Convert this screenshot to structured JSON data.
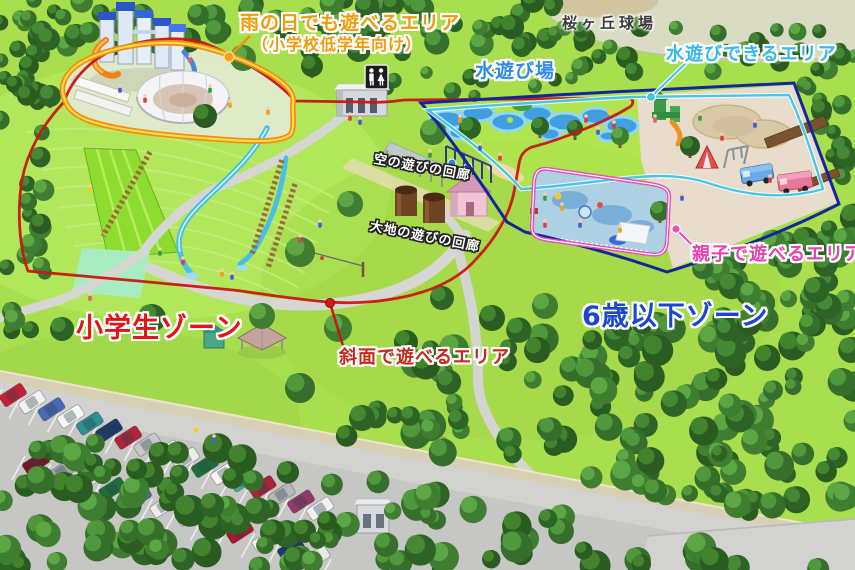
{
  "map": {
    "labels": {
      "rain_area": {
        "line1": "雨の日でも遊べるエリア",
        "line2": "（小学校低学年向け）",
        "color": "#f29a08"
      },
      "ballpark": {
        "text": "桜ヶ丘球場",
        "color": "#3a3a3a"
      },
      "water_play_spot": {
        "text": "水遊び場",
        "color": "#2e8ce8"
      },
      "water_play_area": {
        "text": "水遊びできるエリア",
        "color": "#35b8ec"
      },
      "sky_corridor": {
        "text": "空の遊びの回廊",
        "color": "#ffffff"
      },
      "earth_corridor": {
        "text": "大地の遊びの回廊",
        "color": "#ffffff"
      },
      "parent_child_area": {
        "text": "親子で遊べるエリア",
        "color": "#ea3fae"
      },
      "under_six_zone": {
        "text": "6歳以下ゾーン",
        "color": "#1b46d0"
      },
      "elementary_zone": {
        "text": "小学生ゾーン",
        "color": "#e41414"
      },
      "slope_play_area": {
        "text": "斜面で遊べるエリア",
        "color": "#c8281c"
      }
    },
    "zone_line_colors": {
      "elementary": "#c81810",
      "under_six": "#15259a",
      "rain": "#f08c10",
      "water": "#45c8e8",
      "parent_child": "#e84fb8"
    },
    "icons": {
      "restroom_sign": "male-and-female-figures"
    },
    "parking": {
      "row_upper_car_colors": [
        "#c22233",
        "#f2f2f0",
        "#4a6ab8",
        "#f8f8f6",
        "#2f9090",
        "#1c3a6e",
        "#b22438",
        "#c8c8c8",
        "#f4f4f2",
        "#ececea",
        "#1f7038",
        "#f6f6f4",
        "#3fa8a0",
        "#aa2438",
        "#b8b8b8",
        "#8f3a68",
        "#f2f2f0"
      ],
      "row_lower_car_colors": [
        "#7a1526",
        "#a8a8a8",
        "#f4f4f2",
        "#1f7038",
        "#4a6ab8",
        "#ececea",
        "#d8d8d6",
        "#f6f6f4",
        "#a81a2a",
        "#f2f2f0",
        "#22366e",
        "#e8e8e6"
      ]
    }
  }
}
